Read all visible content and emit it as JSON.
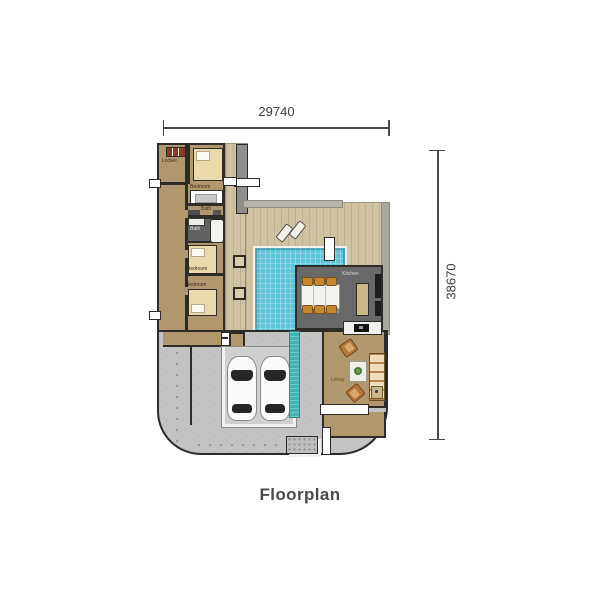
{
  "title": "Floorplan",
  "dimensions": {
    "width": "29740",
    "height": "38670"
  },
  "rooms": {
    "locker": "Locker",
    "bedroom_top": "Bedroom",
    "bath_small": "Bath",
    "bath_dark": "Bath",
    "bedroom_mid": "Bedroom",
    "bedroom_bottom": "Bedroom",
    "kitchen": "Kitchen",
    "dining": "Dining",
    "living": "Living"
  },
  "colors": {
    "wall": "#2e2c28",
    "room_floor": "#b1976e",
    "deck": "#cfc3a3",
    "pool_water": "#5ec4d7",
    "tile_dark": "#666262",
    "driveway": "#c3c3c3",
    "water_feature": "#41b5b4",
    "furniture_accent": "#c8862e"
  }
}
